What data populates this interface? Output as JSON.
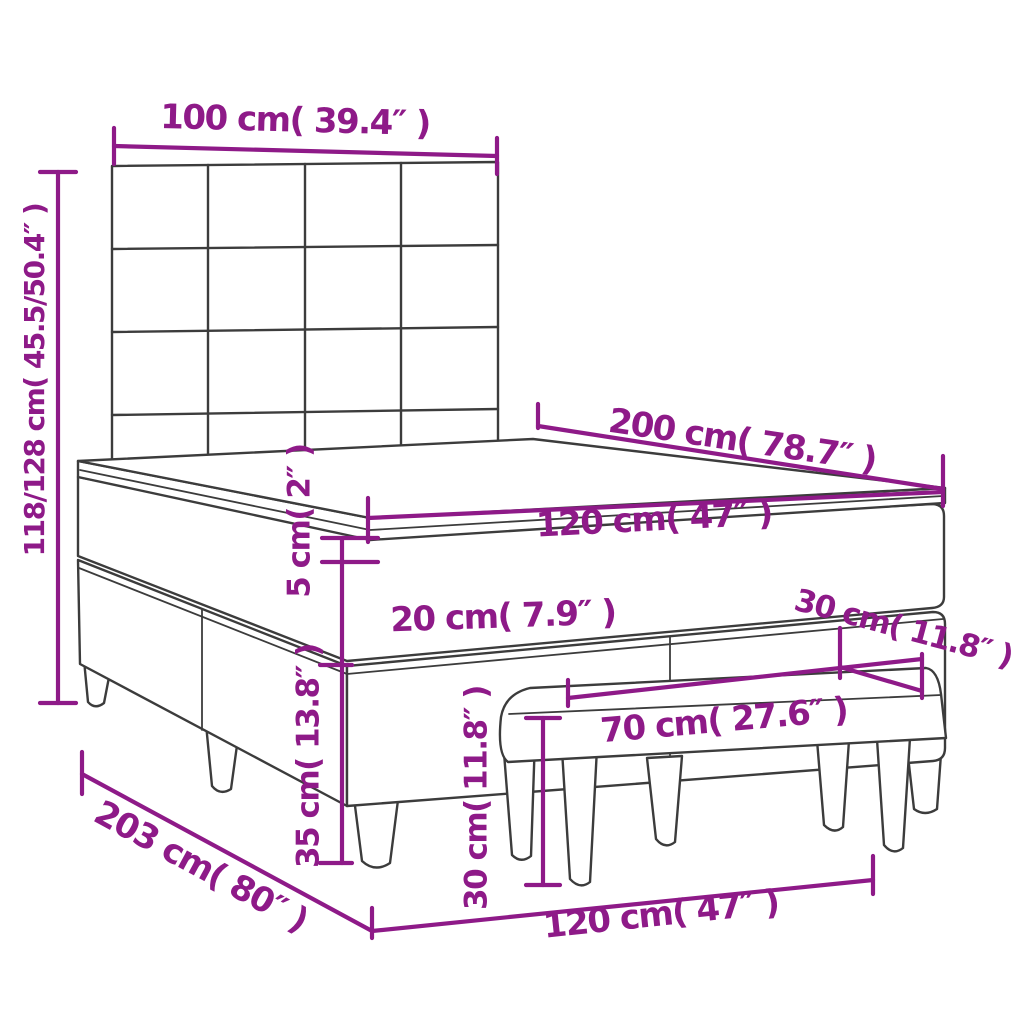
{
  "diagram": {
    "type": "product-dimension-diagram",
    "background_color": "#FFFFFF",
    "outline_color": "#3C3C3C",
    "accent_color": "#8E1A88",
    "objects": [
      "headboard",
      "mattress-topper",
      "mattress",
      "box-spring-base",
      "bed-legs",
      "bench"
    ],
    "dimensions": {
      "headboard_width": "100 cm( 39.4″ )",
      "bed_height": "118/128 cm( 45.5/50.4″ )",
      "bed_length_top": "200 cm( 78.7″ )",
      "mattress_width_top": "120 cm( 47″ )",
      "topper_thickness": "5 cm( 2″ )",
      "mattress_thickness": "20 cm( 7.9″ )",
      "bench_depth": "30 cm( 11.8″ )",
      "bench_width": "70 cm( 27.6″ )",
      "base_height": "35 cm( 13.8″ )",
      "bench_height": "30 cm( 11.8″ )",
      "total_length_floor": "203 cm( 80″ )",
      "bed_width_floor": "120 cm( 47″ )"
    }
  }
}
